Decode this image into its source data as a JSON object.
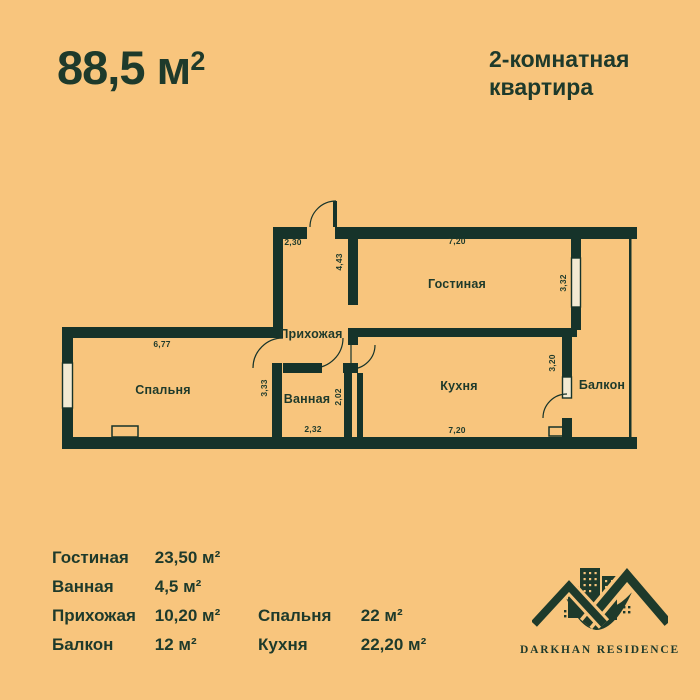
{
  "colors": {
    "background": "#f8c57d",
    "ink": "#1e3a2b",
    "wall": "#16332a",
    "window_fill": "#f2ead3"
  },
  "header": {
    "area_main": "88,5 м",
    "area_sup": "2",
    "type_line1": "2-комнатная",
    "type_line2": "квартира"
  },
  "plan": {
    "rooms": {
      "hall": "Прихожая",
      "living": "Гостиная",
      "bedroom": "Спальня",
      "bath": "Ванная",
      "kitchen": "Кухня",
      "balcony": "Балкон"
    },
    "dimensions": {
      "hall_top": "2,30",
      "hall_height": "4,43",
      "living_width": "7,20",
      "living_height": "3,32",
      "bedroom_width": "6,77",
      "bath_height": "3,33",
      "bath_height2": "2,02",
      "bath_width": "2,32",
      "kitchen_height": "3,20",
      "kitchen_width": "7,20"
    }
  },
  "legend": {
    "col1": [
      {
        "label": "Гостиная",
        "value": "23,50 м²"
      },
      {
        "label": "Ванная",
        "value": "4,5 м²"
      },
      {
        "label": "Прихожая",
        "value": "10,20 м²"
      },
      {
        "label": "Балкон",
        "value": "12 м²"
      }
    ],
    "col2": [
      {
        "label": "Спальня",
        "value": "22 м²"
      },
      {
        "label": "Кухня",
        "value": "22,20 м²"
      }
    ]
  },
  "logo": {
    "name": "DARKHAN RESIDENCE"
  }
}
